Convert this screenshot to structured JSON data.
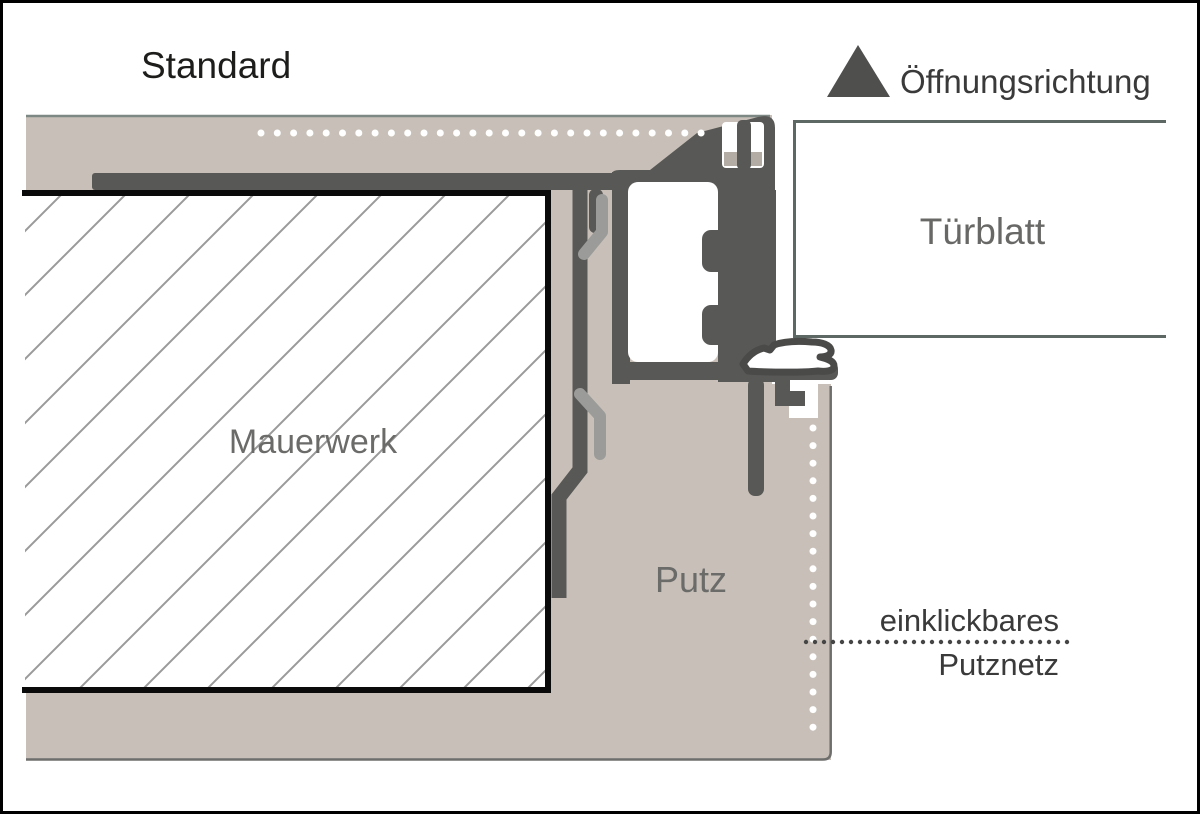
{
  "title": "Standard",
  "legend": {
    "opening_direction_label": "Öffnungsrichtung",
    "opening_direction_icon": "triangle-up-icon"
  },
  "labels": {
    "door_leaf": "Türblatt",
    "masonry": "Mauerwerk",
    "plaster": "Putz",
    "mesh_line1": "einklickbares",
    "mesh_line2": "Putznetz"
  },
  "colors": {
    "plaster_fill": "#c8c0b8",
    "plaster_edge_line": "#6e6e6d",
    "band_top_line": "#7d8784",
    "frame_dark": "#585856",
    "anchor_light": "#9b9b99",
    "notch_sill": "#b3aca5",
    "hatch_line": "#9a9a9a",
    "masonry_border": "#0a0a0a",
    "door_leaf_border": "#5d6763",
    "seal_outline": "#4a4a49",
    "triangle_fill": "#4f4f4e",
    "white": "#ffffff"
  },
  "dots": {
    "horizontal_mesh": {
      "x0": 261,
      "y": 133,
      "step": 16.3,
      "count": 28,
      "r": 3.5,
      "color": "#ffffff"
    },
    "vertical_mesh": {
      "x": 813,
      "y0": 428,
      "step": 17.6,
      "count": 18,
      "r": 3.5,
      "color": "#ffffff"
    },
    "leader_line": {
      "x0": 806,
      "y": 642,
      "step": 9,
      "count": 30,
      "r": 2.2,
      "color": "#454545"
    }
  }
}
